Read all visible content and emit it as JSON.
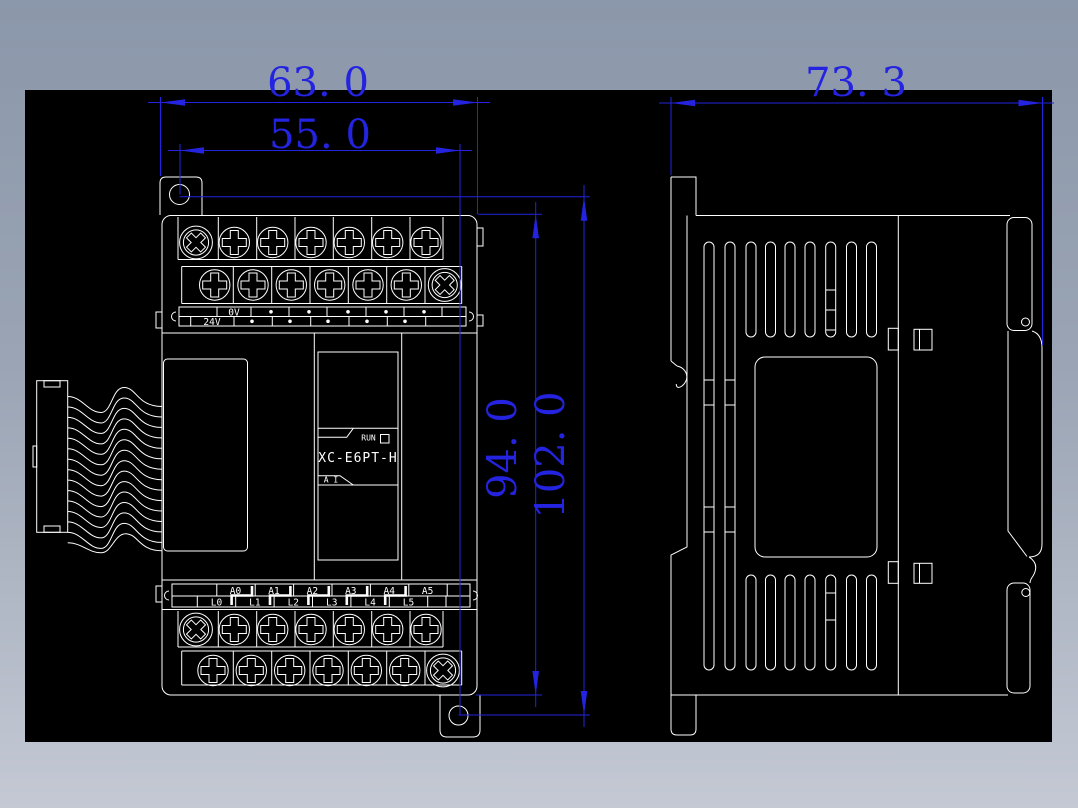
{
  "window": {
    "type": "cad-drawing-viewport",
    "canvas_color": "#000000",
    "frame_top_color": "#8b97aa",
    "frame_bottom_color": "#c4c9d4",
    "line_color": "#ffffff",
    "dimension_color": "#2323e0"
  },
  "dimensions": {
    "front_width_outer": "63. 0",
    "front_width_holes": "55. 0",
    "side_depth": "73. 3",
    "front_height_body": "94. 0",
    "front_height_overall": "102. 0"
  },
  "front_view": {
    "model": "XC-E6PT-H",
    "run_label": "RUN",
    "ai_label": "A I",
    "top_strip": {
      "row1_label": "0V",
      "row2_label": "24V"
    },
    "bottom_strip": {
      "row1": [
        "A0",
        "A1",
        "A2",
        "A3",
        "A4",
        "A5"
      ],
      "row2": [
        "L0",
        "L1",
        "L2",
        "L3",
        "L4",
        "L5"
      ]
    }
  }
}
